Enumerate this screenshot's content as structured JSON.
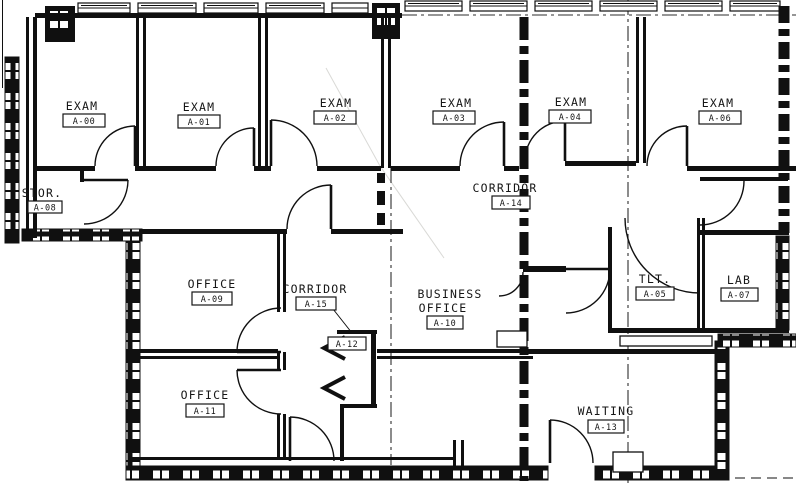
{
  "plan": {
    "type": "architectural-floor-plan",
    "colors": {
      "ink": "#101010",
      "paper": "#ffffff"
    },
    "rooms": [
      {
        "name": "EXAM",
        "number": "A-00"
      },
      {
        "name": "EXAM",
        "number": "A-01"
      },
      {
        "name": "EXAM",
        "number": "A-02"
      },
      {
        "name": "EXAM",
        "number": "A-03"
      },
      {
        "name": "EXAM",
        "number": "A-04"
      },
      {
        "name": "EXAM",
        "number": "A-06"
      },
      {
        "name": "STOR.",
        "number": "A-08"
      },
      {
        "name": "CORRIDOR",
        "number": "A-14"
      },
      {
        "name": "OFFICE",
        "number": "A-09"
      },
      {
        "name": "CORRIDOR",
        "number": "A-15"
      },
      {
        "name": "BUSINESS",
        "name2": "OFFICE",
        "number": "A-10"
      },
      {
        "name": "TLT.",
        "number": "A-05"
      },
      {
        "name": "LAB",
        "number": "A-07"
      },
      {
        "name": "OFFICE",
        "number": "A-11"
      },
      {
        "name": "WAITING",
        "number": "A-13"
      },
      {
        "number": "A-12"
      }
    ]
  }
}
